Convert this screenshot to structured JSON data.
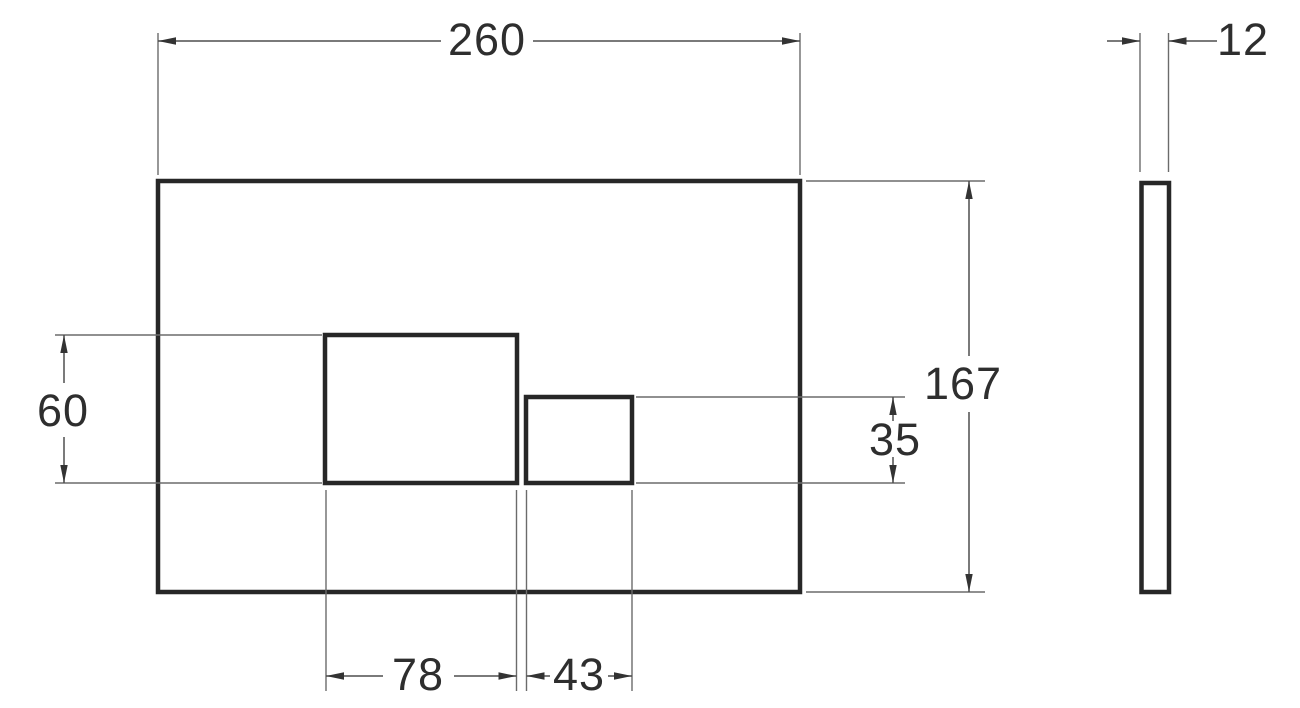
{
  "dimensions": {
    "overall_width": "260",
    "overall_height": "167",
    "thickness": "12",
    "large_cutout_width": "78",
    "large_cutout_height": "60",
    "small_cutout_width": "43",
    "small_cutout_height": "35"
  },
  "colors": {
    "outline": "#272727",
    "dimension_lines": "#6b6b6b",
    "label_text": "#2e2e2e",
    "background": "#ffffff"
  }
}
